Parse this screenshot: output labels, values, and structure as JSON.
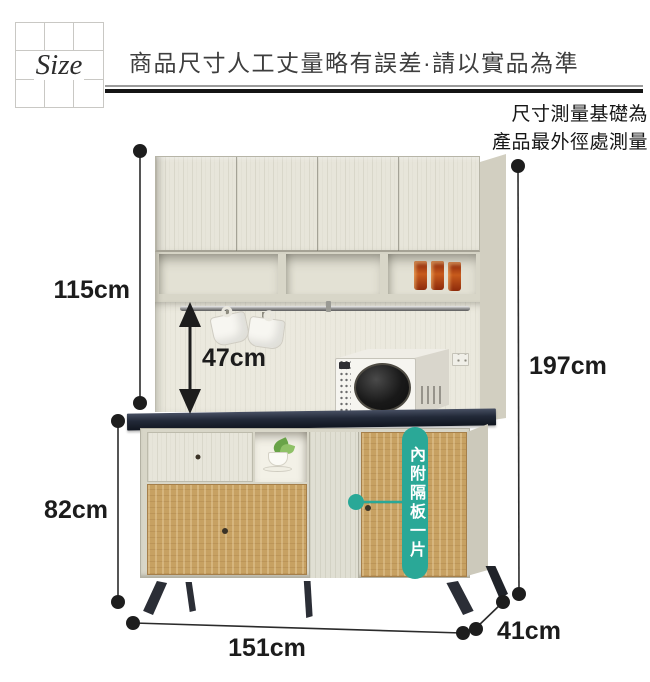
{
  "header": {
    "logo_text": "Size",
    "disclaimer": "商品尺寸人工丈量略有誤差·請以實品為準",
    "measure_note_line1": "尺寸測量基礎為",
    "measure_note_line2": "產品最外徑處測量"
  },
  "dimensions": {
    "upper_hutch_height": "115cm",
    "rail_to_counter_clearance": "47cm",
    "lower_cabinet_height": "82cm",
    "total_height": "197cm",
    "total_width": "151cm",
    "depth": "41cm"
  },
  "callout": {
    "label": "內附隔板一片"
  },
  "colors": {
    "callout_teal": "#2aa897",
    "countertop": "#222938",
    "oak_wood": "#c7a162",
    "cream_wood": "#e7e5da",
    "annotation_black": "#1d1d1d"
  }
}
